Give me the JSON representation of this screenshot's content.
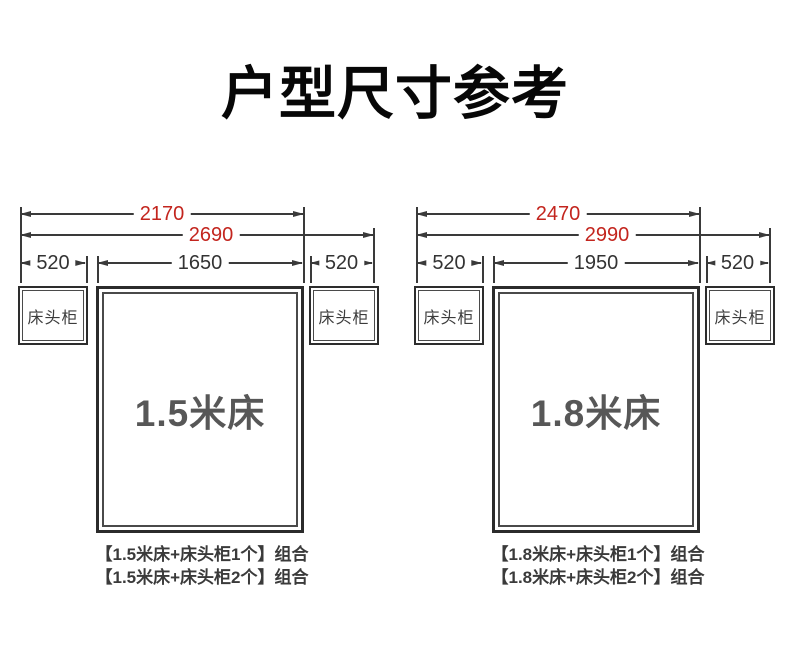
{
  "title": "户型尺寸参考",
  "colors": {
    "dimension_number_red": "#c3251e",
    "line_dark": "#3a3a3a",
    "bed_label_gray": "#575757",
    "background": "#ffffff"
  },
  "diagrams": [
    {
      "bed_label": "1.5米床",
      "nightstand_label": "床头柜",
      "dims": {
        "bed_plus_one_nightstand": "2170",
        "bed_plus_two_nightstands": "2690",
        "left_nightstand_width": "520",
        "bed_width": "1650",
        "right_nightstand_width": "520"
      },
      "captions": [
        "【1.5米床+床头柜1个】组合",
        "【1.5米床+床头柜2个】组合"
      ]
    },
    {
      "bed_label": "1.8米床",
      "nightstand_label": "床头柜",
      "dims": {
        "bed_plus_one_nightstand": "2470",
        "bed_plus_two_nightstands": "2990",
        "left_nightstand_width": "520",
        "bed_width": "1950",
        "right_nightstand_width": "520"
      },
      "captions": [
        "【1.8米床+床头柜1个】组合",
        "【1.8米床+床头柜2个】组合"
      ]
    }
  ]
}
